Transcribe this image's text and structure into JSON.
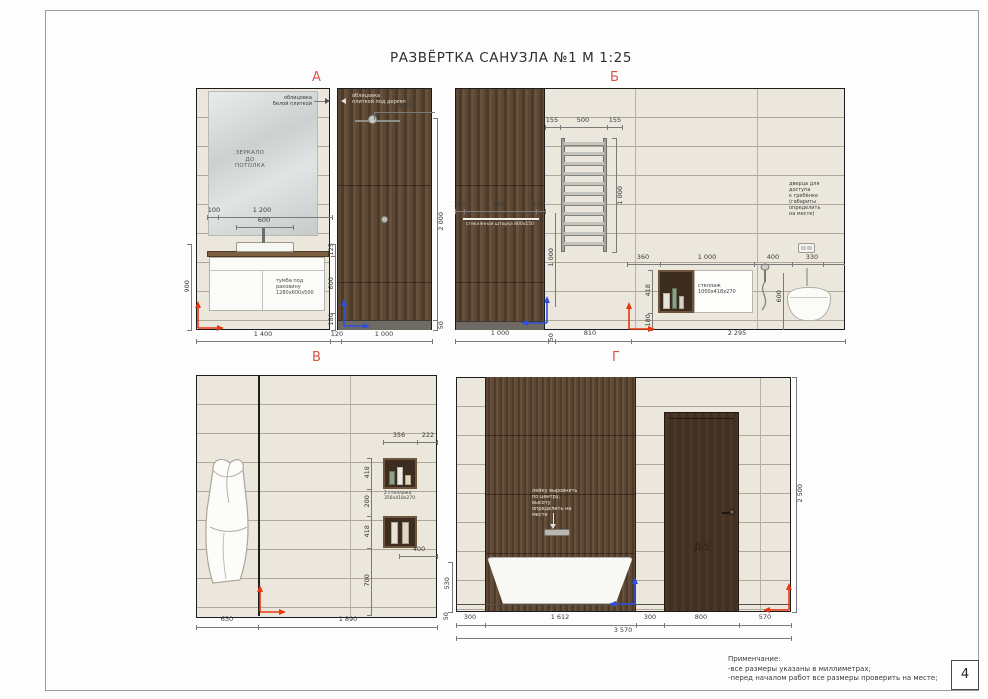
{
  "title": "РАЗВЁРТКА САНУЗЛА №1  М 1:25",
  "page_number": "4",
  "notes": {
    "heading": "Применчание:",
    "lines": "-все размеры указаны в миллиметрах;\n-перед началом работ все размеры проверить на месте;"
  },
  "colors": {
    "view_label": "#d9534a",
    "axis_red": "#e8380f",
    "axis_blue": "#2d4fe0",
    "wood": "#57432f",
    "tile": "#ebe7dc",
    "door": "#47352a"
  },
  "view_a": {
    "label": "А",
    "ann_white_tile": "облицовка\nбелой плиткой",
    "ann_wood_tile": "облицовка\nплиткой под дерево",
    "mirror_note": "ЗЕРКАЛО\nДО\nПОТОЛКА",
    "vanity_note": "тумба под\nраковину\n1280х600х500",
    "dims": {
      "top_100": "100",
      "top_1200": "1 200",
      "top_600": "600",
      "left_900": "900",
      "right_125": "125",
      "right_600": "600",
      "right_180": "180",
      "bottom_1400": "1 400",
      "bottom_120": "120",
      "shower_500": "500",
      "wood_2000": "2 000",
      "wood_50": "50",
      "wood_bottom_1000": "1 000"
    }
  },
  "view_b": {
    "label": "Б",
    "ann_access": "дверца для\nдоступа\nк гребёнке\n(габариты\nопределить\nна месте)",
    "glass_note": "стеклянная шторка 800х150",
    "shelf_note": "стеллаж\n1000х418х270",
    "dims": {
      "rail_155l": "155",
      "rail_500": "500",
      "rail_155r": "155",
      "rail_1000": "1 000",
      "glass_100l": "100",
      "glass_800": "800",
      "glass_100r": "100",
      "left_1000": "1 000",
      "niche_360": "360",
      "niche_1000": "1 000",
      "niche_400": "400",
      "niche_330": "330",
      "niche_418": "418",
      "niche_180": "180",
      "shower_600": "600",
      "bottom_1000": "1 000",
      "bottom_50": "50",
      "bottom_810": "810",
      "bottom_2295": "2 295"
    }
  },
  "view_v": {
    "label": "В",
    "shelf_note": "2 стеллажа\n356х418х270",
    "dims": {
      "top_356": "356",
      "top_222": "222",
      "v_418a": "418",
      "v_200": "200",
      "v_418b": "418",
      "v_700": "700",
      "b_400": "400",
      "bottom_630": "630",
      "bottom_1890": "1 890"
    }
  },
  "view_g": {
    "label": "Г",
    "ann_spout": "лейку выровнять\nпо центру, высоту\nопределить на\nместе",
    "door_label": "Д-5",
    "dims": {
      "right_2500": "2 500",
      "tub_530": "530",
      "tub_50": "50",
      "b_300l": "300",
      "b_1612": "1 612",
      "b_300r": "300",
      "b_800": "800",
      "b_570": "570",
      "b_total": "3 570"
    }
  }
}
